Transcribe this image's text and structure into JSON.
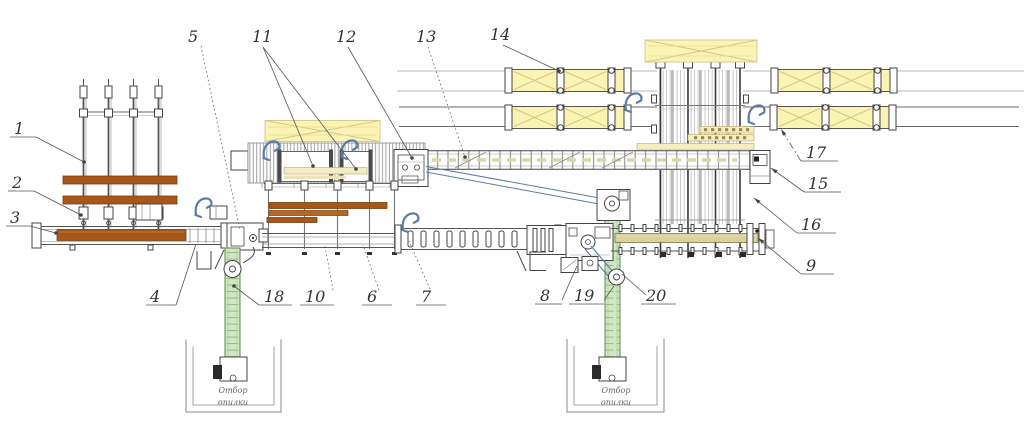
{
  "drawing": {
    "type": "equipment-layout-plan",
    "description": "Plan view of a sawmill / timber sorting line with numbered position callouts",
    "callout_numbers": [
      "1",
      "2",
      "3",
      "4",
      "5",
      "6",
      "7",
      "8",
      "9",
      "10",
      "11",
      "12",
      "13",
      "14",
      "15",
      "16",
      "17",
      "18",
      "19",
      "20"
    ]
  },
  "colors": {
    "line": "#444444",
    "leader": "#555555",
    "brown_beam": "#a8571a",
    "brown_dark": "#7a3c0e",
    "pale_board": "#f3edc0",
    "pale_board_border": "#b9a86a",
    "stack_fill": "#faf4b4",
    "stack_line": "#d6c684",
    "green_fill": "#cfe7c2",
    "green_edge": "#5b8a50",
    "green_rung": "#8fb682",
    "blue_accent": "#5b7ca6",
    "khaki_board": "#d9d19e",
    "hatch_line": "#8a8a8a",
    "pit_wall": "#8a8a8a",
    "text": "#333333"
  },
  "icons": {
    "cant_hook": "blue curved turning-hook arrow",
    "chute": "open rectangle with slash"
  },
  "pits": [
    {
      "line1": "Отбор",
      "line2": "опилки"
    },
    {
      "line1": "Отбор",
      "line2": "опилки"
    }
  ],
  "callouts": [
    {
      "n": "1",
      "x": 14,
      "y": 134,
      "ul": [
        10,
        36,
        137
      ],
      "lead": [
        36,
        137,
        84,
        162
      ],
      "style": "solid",
      "end": "dot"
    },
    {
      "n": "2",
      "x": 12,
      "y": 188,
      "ul": [
        8,
        34,
        191
      ],
      "lead": [
        34,
        191,
        81,
        215
      ],
      "style": "solid",
      "end": "dot"
    },
    {
      "n": "3",
      "x": 10,
      "y": 223,
      "ul": [
        6,
        30,
        226
      ],
      "lead": [
        30,
        226,
        56,
        233
      ],
      "style": "solid",
      "end": "dot"
    },
    {
      "n": "4",
      "x": 150,
      "y": 302,
      "ul": [
        146,
        176,
        305
      ],
      "lead": [
        176,
        305,
        196,
        244
      ],
      "style": "solid",
      "end": "none"
    },
    {
      "n": "5",
      "x": 188,
      "y": 42,
      "lead": [
        201,
        46,
        240,
        230
      ],
      "style": "dotted",
      "end": "none"
    },
    {
      "n": "11",
      "x": 252,
      "y": 42,
      "lead": [
        263,
        47,
        313,
        166
      ],
      "lead2": [
        263,
        47,
        356,
        169
      ],
      "style": "solid",
      "end": "dot"
    },
    {
      "n": "12",
      "x": 336,
      "y": 42,
      "lead": [
        348,
        47,
        412,
        158
      ],
      "style": "solid",
      "end": "dot"
    },
    {
      "n": "13",
      "x": 416,
      "y": 42,
      "lead": [
        428,
        47,
        465,
        157
      ],
      "style": "dotted",
      "end": "dot"
    },
    {
      "n": "14",
      "x": 490,
      "y": 40,
      "lead": [
        503,
        45,
        559,
        71
      ],
      "style": "solid",
      "end": "dot"
    },
    {
      "n": "17",
      "x": 806,
      "y": 158,
      "ul": [
        801,
        838,
        161
      ],
      "lead": [
        801,
        161,
        781,
        129
      ],
      "style": "dashdot",
      "end": "arrow"
    },
    {
      "n": "15",
      "x": 808,
      "y": 189,
      "ul": [
        804,
        841,
        192
      ],
      "lead": [
        804,
        192,
        771,
        168
      ],
      "style": "solid",
      "end": "arrow"
    },
    {
      "n": "16",
      "x": 801,
      "y": 230,
      "ul": [
        797,
        836,
        233
      ],
      "lead": [
        797,
        233,
        754,
        198
      ],
      "style": "solid",
      "end": "arrow"
    },
    {
      "n": "9",
      "x": 806,
      "y": 271,
      "ul": [
        801,
        834,
        274
      ],
      "lead": [
        801,
        274,
        758,
        238
      ],
      "style": "solid",
      "end": "arrow"
    },
    {
      "n": "18",
      "x": 264,
      "y": 302,
      "ul": [
        259,
        292,
        305
      ],
      "lead": [
        259,
        305,
        234,
        286
      ],
      "style": "solid",
      "end": "dot"
    },
    {
      "n": "10",
      "x": 305,
      "y": 302,
      "ul": [
        300,
        334,
        305
      ],
      "lead": [
        333,
        290,
        325,
        246
      ],
      "style": "dotted",
      "end": "none"
    },
    {
      "n": "6",
      "x": 367,
      "y": 302,
      "ul": [
        362,
        392,
        305
      ],
      "lead": [
        379,
        290,
        363,
        245
      ],
      "style": "dotted",
      "end": "none"
    },
    {
      "n": "7",
      "x": 421,
      "y": 302,
      "ul": [
        416,
        446,
        305
      ],
      "lead": [
        430,
        289,
        409,
        241
      ],
      "style": "dotted",
      "end": "none"
    },
    {
      "n": "8",
      "x": 540,
      "y": 301,
      "ul": [
        535,
        562,
        304
      ],
      "lead": [
        562,
        300,
        577,
        266
      ],
      "style": "solid",
      "end": "none"
    },
    {
      "n": "19",
      "x": 574,
      "y": 301,
      "ul": [
        569,
        604,
        304
      ],
      "lead": [
        604,
        300,
        614,
        286
      ],
      "style": "solid",
      "end": "none"
    },
    {
      "n": "20",
      "x": 646,
      "y": 301,
      "ul": [
        641,
        676,
        304
      ],
      "lead": [
        646,
        295,
        622,
        274
      ],
      "style": "solid",
      "end": "none"
    }
  ]
}
